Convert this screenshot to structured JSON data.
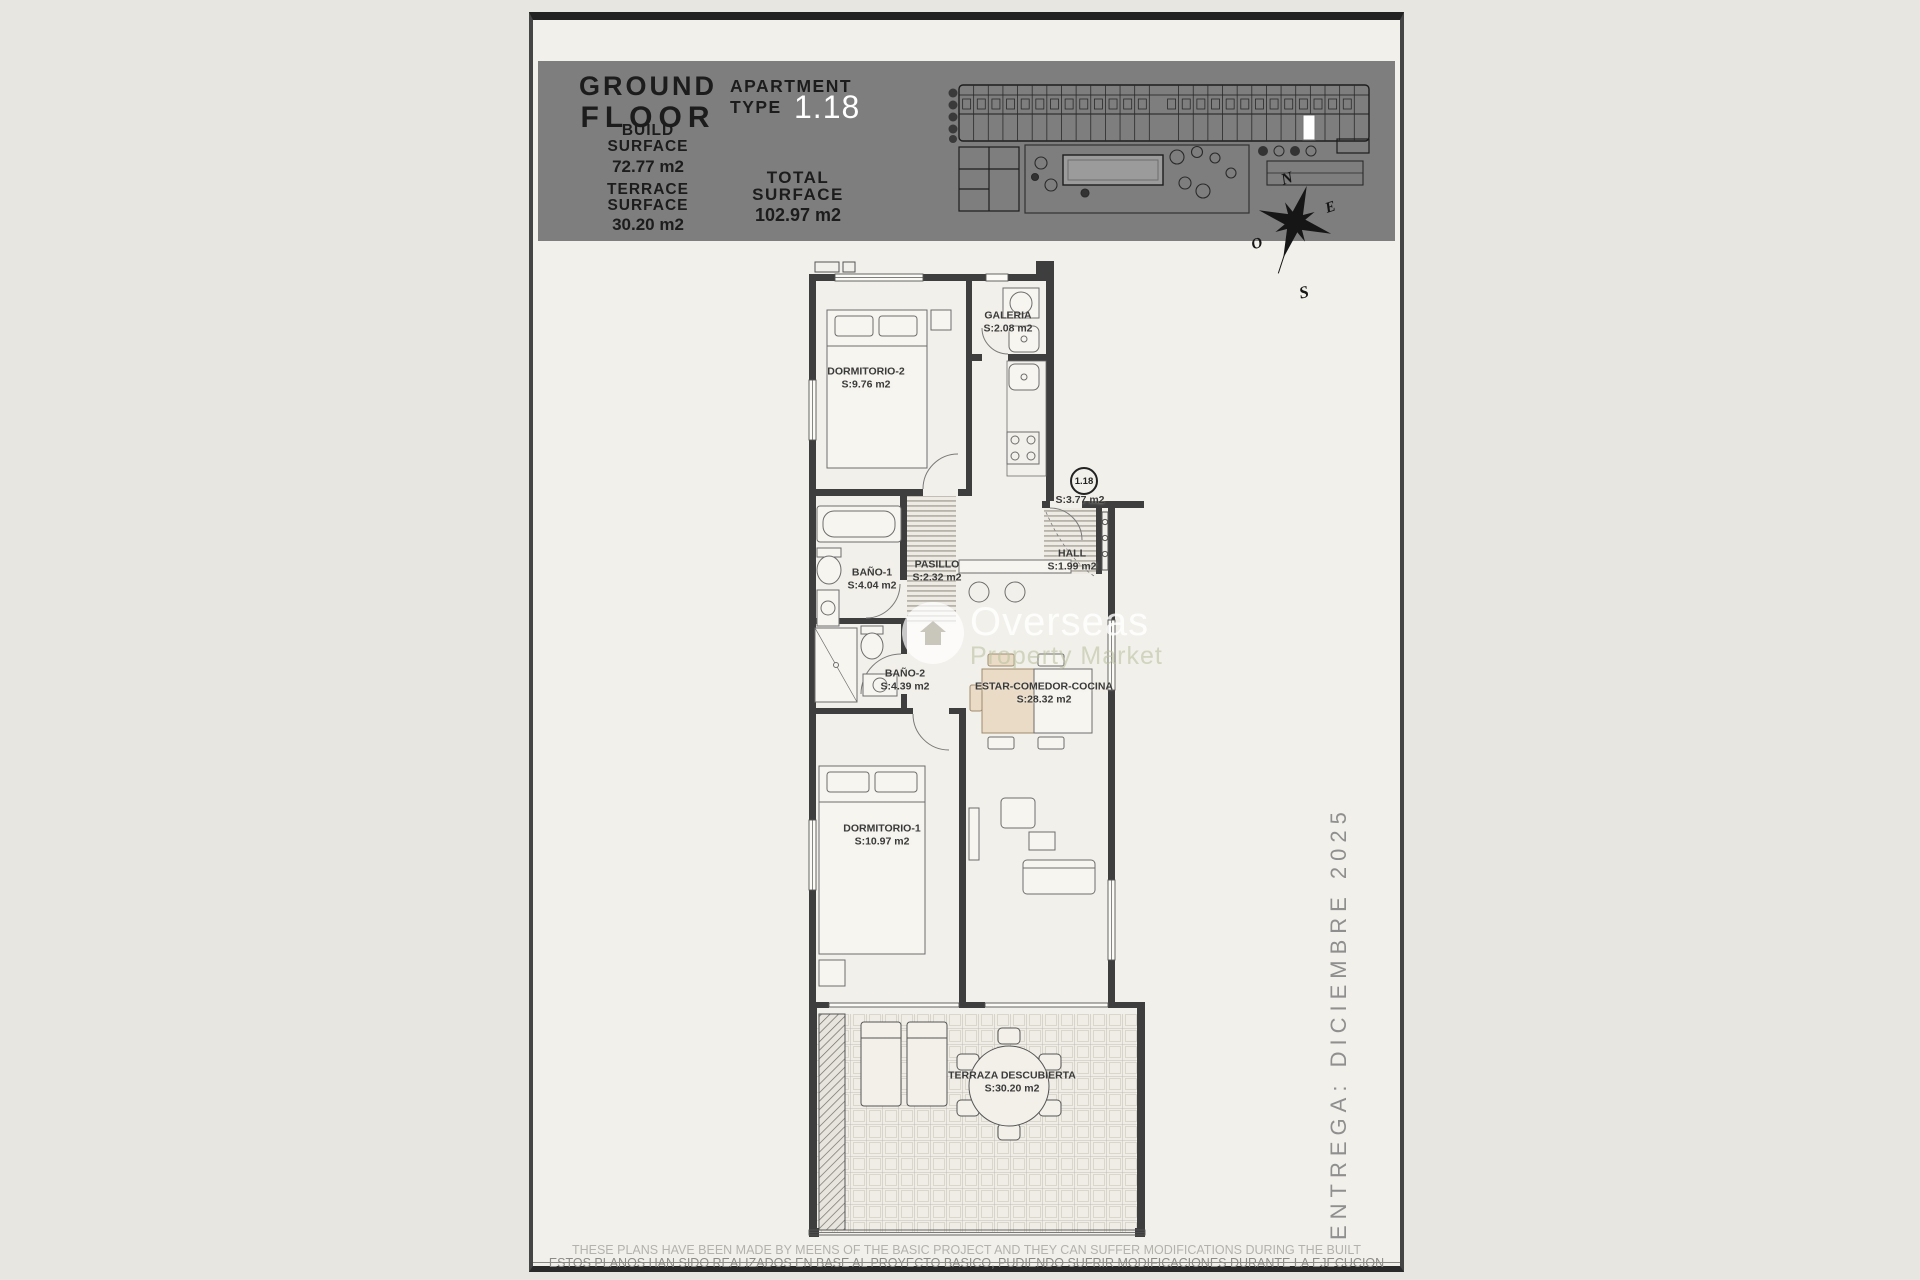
{
  "page": {
    "header": {
      "floor": {
        "line1": "GROUND",
        "line2": "FLOOR"
      },
      "apartment": {
        "label_line1": "APARTMENT",
        "label_line2": "TYPE",
        "number": "1.18"
      },
      "build_surface": {
        "label": "BUILD\nSURFACE",
        "value": "72.77 m2"
      },
      "terrace_surface": {
        "label": "TERRACE\nSURFACE",
        "value": "30.20 m2"
      },
      "total_surface": {
        "label": "TOTAL\nSURFACE",
        "value": "102.97 m2"
      }
    },
    "compass": {
      "north": "N",
      "south": "S",
      "east": "E",
      "west": "O"
    },
    "plan": {
      "unit_badge": "1.18",
      "entry_area": "S:3.77 m2",
      "rooms": [
        {
          "name": "DORMITORIO-2",
          "area": "S:9.76 m2"
        },
        {
          "name": "GALERIA",
          "area": "S:2.08 m2"
        },
        {
          "name": "BAÑO-1",
          "area": "S:4.04 m2"
        },
        {
          "name": "PASILLO",
          "area": "S:2.32 m2"
        },
        {
          "name": "HALL",
          "area": "S:1.99 m2"
        },
        {
          "name": "BAÑO-2",
          "area": "S:4.39 m2"
        },
        {
          "name": "ESTAR-COMEDOR-COCINA",
          "area": "S:28.32 m2"
        },
        {
          "name": "DORMITORIO-1",
          "area": "S:10.97 m2"
        },
        {
          "name": "TERRAZA DESCUBIERTA",
          "area": "S:30.20 m2"
        }
      ]
    },
    "watermark": {
      "line1": "Overseas",
      "line2": "Property Market"
    },
    "delivery": "ENTREGA: DICIEMBRE 2025",
    "disclaimer": {
      "line1": "THESE PLANS HAVE BEEN MADE BY MEENS OF THE BASIC PROJECT AND THEY CAN SUFFER MODIFICATIONS DURING THE BUILT",
      "line2": "ESTOS PLANOS HAN SIDO REALIZADOS EN BASE AL PROYECTO BASICO, PUDIENDO SUFRIR MODIFICACIONES DURANTE LA EJECUCION"
    },
    "colors": {
      "header_bg": "#7e7e7e",
      "accent_text": "#ffffff",
      "ink": "#1c1c1c",
      "muted": "#8f8f8f"
    }
  }
}
